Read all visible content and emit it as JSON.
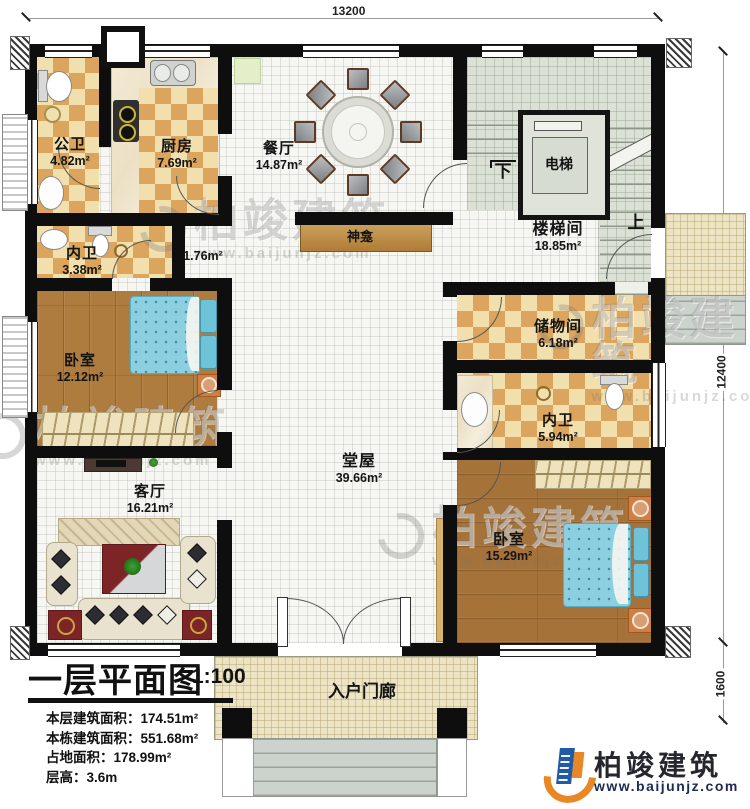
{
  "dimensions": {
    "top": "13200",
    "right_main": "12400",
    "right_porch": "1600"
  },
  "rooms": {
    "gongwei": {
      "name": "公卫",
      "area": "4.82m²"
    },
    "chufang": {
      "name": "厨房",
      "area": "7.69m²"
    },
    "canting": {
      "name": "餐厅",
      "area": "14.87m²"
    },
    "dianti": {
      "name": "电梯"
    },
    "loutijian": {
      "name": "楼梯间",
      "area": "18.85m²"
    },
    "neiwei1": {
      "name": "内卫",
      "area": "3.38m²"
    },
    "shenkan": {
      "name": "神龛",
      "area": "1.76m²"
    },
    "woshi1": {
      "name": "卧室",
      "area": "12.12m²"
    },
    "chuwujian": {
      "name": "储物间",
      "area": "6.18m²"
    },
    "neiwei2": {
      "name": "内卫",
      "area": "5.94m²"
    },
    "tangwu": {
      "name": "堂屋",
      "area": "39.66m²"
    },
    "keting": {
      "name": "客厅",
      "area": "16.21m²"
    },
    "woshi2": {
      "name": "卧室",
      "area": "15.29m²"
    },
    "rumenlang": {
      "name": "入户门廊"
    }
  },
  "stairs": {
    "down": "下",
    "up": "上"
  },
  "info": {
    "title": "一层平面图",
    "scale": "1:100",
    "lines": [
      "本层建筑面积：174.51m²",
      "本栋建筑面积：551.68m²",
      "占地面积：178.99m²",
      "层高：3.6m"
    ]
  },
  "brand": {
    "name": "柏竣建筑",
    "url": "www.baijunjz.com"
  },
  "watermark": {
    "name": "柏竣建筑",
    "url": "www.baijunjz.com"
  },
  "colors": {
    "brand_orange": "#e88726",
    "brand_blue": "#1f5ba6",
    "wall": "#0e0e0e",
    "checker_dark": "#dba55d",
    "stair_green": "#dbe1d5"
  }
}
